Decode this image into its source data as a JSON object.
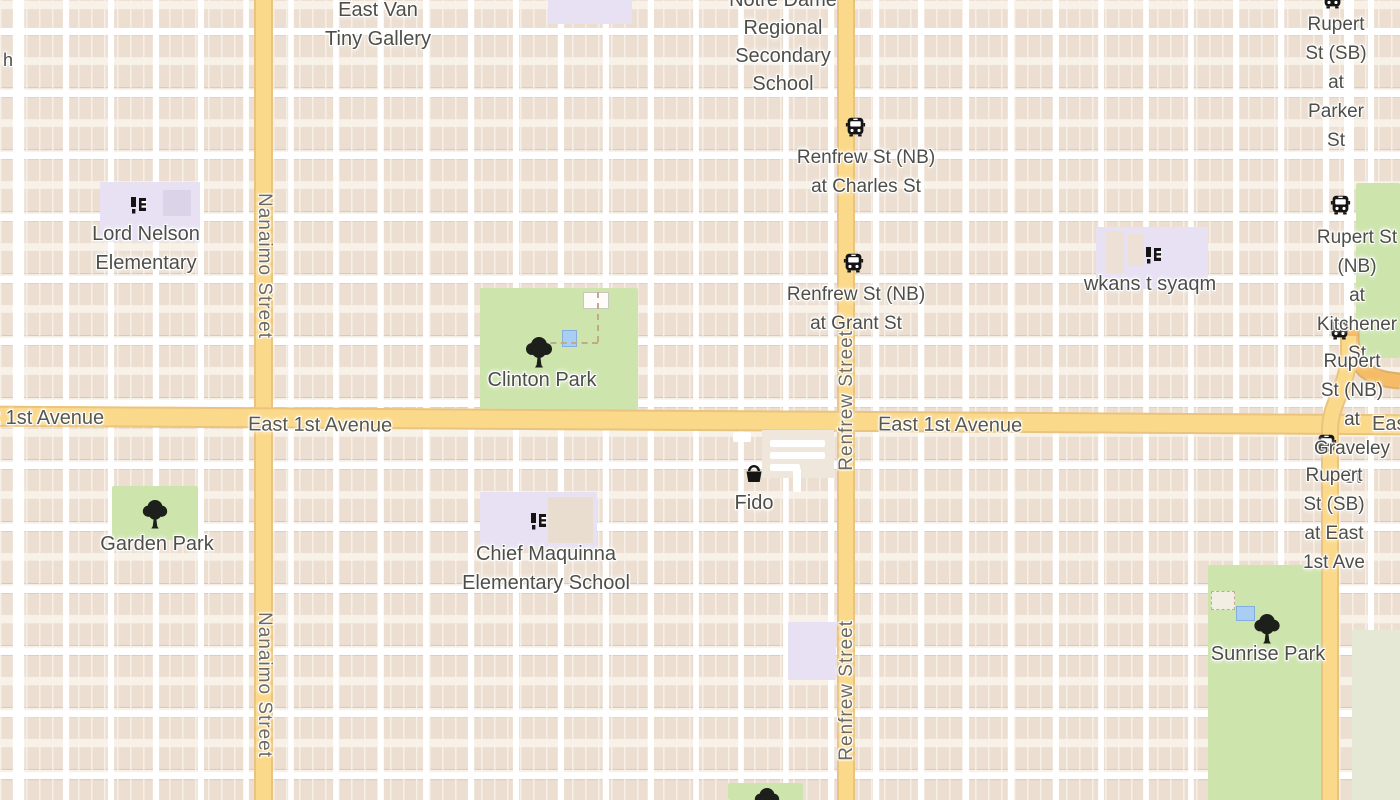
{
  "map_type": "street-map",
  "city_area": "East Vancouver",
  "roads": {
    "east_1st_avenue": "East 1st Avenue",
    "nanaimo_street": "Nanaimo Street",
    "renfrew_street": "Renfrew Street"
  },
  "pois": {
    "east_van_tiny_gallery": "East Van\nTiny Gallery",
    "notre_dame": "Notre Dame\nRegional\nSecondary\nSchool",
    "lord_nelson": "Lord Nelson\nElementary",
    "wkans": "wkans t syaqm",
    "chief_maquinna": "Chief Maquinna\nElementary School",
    "clinton_park": "Clinton Park",
    "garden_park": "Garden Park",
    "sunrise_park": "Sunrise Park",
    "fido": "Fido",
    "left_edge_partial": "h"
  },
  "bus_stops": {
    "renfrew_charles": "Renfrew St (NB)\nat Charles St",
    "renfrew_grant": "Renfrew St (NB)\nat Grant St",
    "rupert_parker": "Rupert St (SB)\nat Parker St",
    "rupert_kitchener": "Rupert St (NB)\nat Kitchener St",
    "rupert_graveley": "Rupert St (NB)\nat Graveley St",
    "rupert_east1st": "Rupert St (SB)\nat East 1st Ave"
  },
  "icons": {
    "bus-icon": "front view of bus, black rounded square",
    "school-icon": "black column glyphs",
    "tree-icon": "black broadleaf tree",
    "basket-icon": "black shopping basket"
  },
  "colors": {
    "background": "#f6efe7",
    "building_row": "#ecdfd2",
    "street": "#ffffff",
    "major_road": "#fbd98b",
    "major_road_casing": "#eac47f",
    "connector_road": "#f4bc66",
    "park": "#cde5ad",
    "school_area": "#e7e1f3",
    "label_text": "#4d4d49",
    "water_feature": "#a9cef3"
  }
}
